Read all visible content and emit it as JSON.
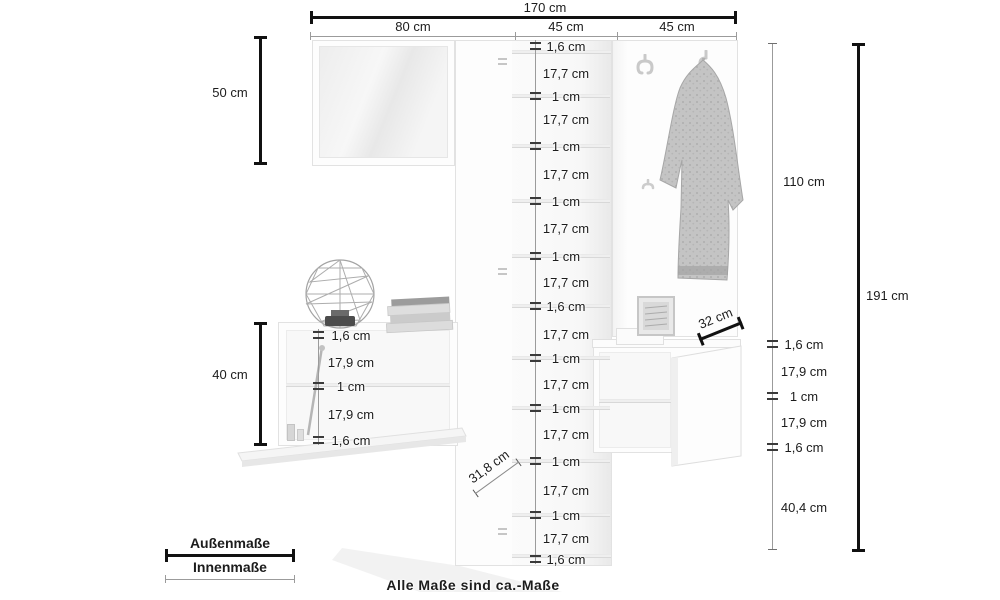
{
  "footnote": "Alle Maße sind ca.-Maße",
  "legend": {
    "outer_label": "Außenmaße",
    "inner_label": "Innenmaße"
  },
  "colors": {
    "outer_line": "#111111",
    "inner_line": "#9b9b9b",
    "text": "#1c1c1c"
  },
  "dims": {
    "total_width": "170 cm",
    "section_widths": [
      "80 cm",
      "45 cm",
      "45 cm"
    ],
    "mirror_height": "50 cm",
    "sideboard_height": "40 cm",
    "panel_height": "110 cm",
    "total_height": "191 cm",
    "bench_depth": "32 cm",
    "cabinet_depth": "31,8 cm"
  },
  "stacks": {
    "shoe_cabinet": [
      "1,6 cm",
      "17,7 cm",
      "1 cm",
      "17,7 cm",
      "1 cm",
      "17,7 cm",
      "1 cm",
      "17,7 cm",
      "1 cm",
      "17,7 cm",
      "1,6 cm",
      "17,7 cm",
      "1 cm",
      "17,7 cm",
      "1 cm",
      "17,7 cm",
      "1 cm",
      "17,7 cm",
      "1 cm",
      "17,7 cm",
      "1,6 cm"
    ],
    "sideboard": [
      "1,6 cm",
      "17,9 cm",
      "1 cm",
      "17,9 cm",
      "1,6 cm"
    ],
    "bench": [
      "1,6 cm",
      "17,9 cm",
      "1 cm",
      "17,9 cm",
      "1,6 cm",
      "40,4 cm"
    ]
  }
}
